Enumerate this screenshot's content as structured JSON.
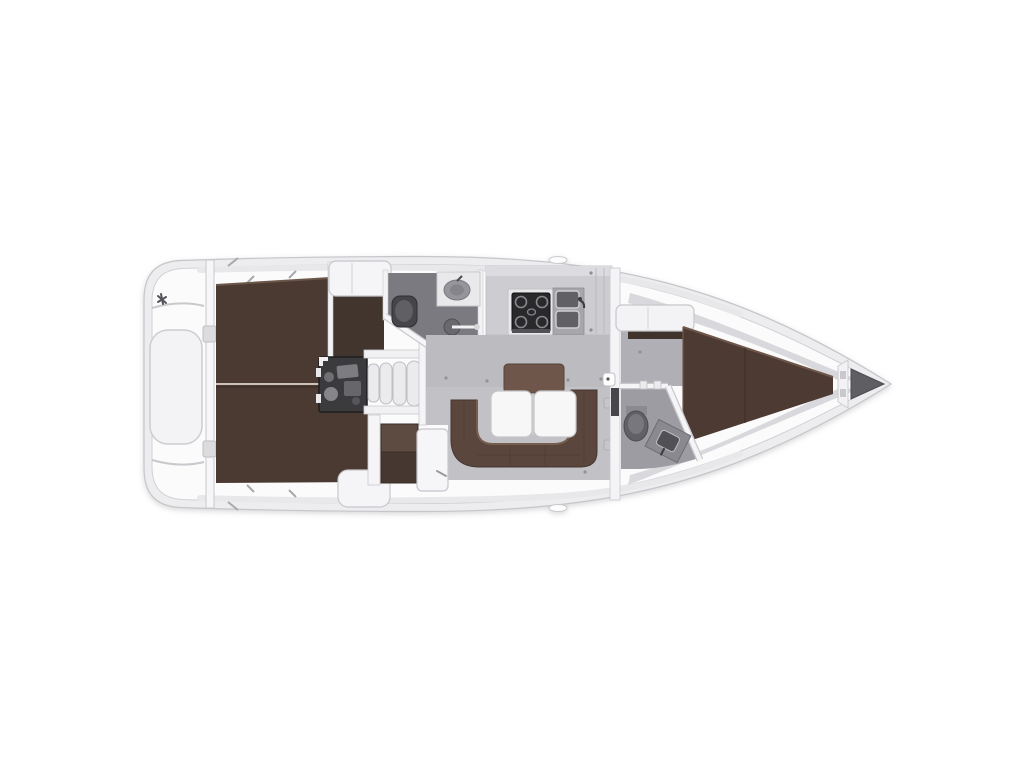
{
  "diagram": {
    "type": "yacht-interior-floor-plan",
    "orientation": "bow-right-stern-left",
    "rooms": [
      "transom-swim-platform",
      "aft-cabin-port-berth",
      "aft-cabin-starboard-berth",
      "engine-compartment",
      "companionway-steps",
      "aft-heads-bathroom",
      "wardrobe-locker",
      "galley",
      "salon-dinette",
      "nav-station",
      "forward-heads-bathroom",
      "forward-cabin-v-berth",
      "anchor-locker"
    ],
    "fixtures": [
      "double-berth",
      "double-berth",
      "v-berth",
      "u-shaped-sofa",
      "backrest-cushion",
      "folding-table",
      "chart-table",
      "nav-seat",
      "stove",
      "double-sink",
      "toilet",
      "washbasin",
      "shower-head",
      "toilet",
      "washbasin",
      "engine",
      "steps",
      "stern-hatch",
      "hinges",
      "door-latch",
      "anchor-well"
    ]
  },
  "palette": {
    "background": "#ffffff",
    "hull_rim": "#ededf0",
    "hull_inner": "#fbfbfc",
    "outline": "#c6c6ca",
    "deck_shade": "#d2d1d6",
    "rim_strip": "#e8e8eb",
    "berth_brown": "#4b3a32",
    "berth_entry_brown": "#42352d",
    "vberth_brown": "#4d3b33",
    "sofa_brown": "#5a463c",
    "backrest_brown": "#6e564b",
    "nav_seat_brown": "#5d4a40",
    "nav_seat_dark": "#463831",
    "salon_floor": "#c2c1c6",
    "salon_floor_shade": "#b7b6bc",
    "fwd_floor": "#b0afb5",
    "aft_heads_floor": "#7b7a80",
    "fwd_heads_floor": "#9d9ca2",
    "counter_gray": "#cdccd1",
    "counter_light": "#dcdbdf",
    "stove_black": "#29292c",
    "burner_gray": "#88888d",
    "sink_gray": "#a7a6ab",
    "basin_dark": "#606065",
    "engine_dark": "#3b3b3e",
    "machinery_gray": "#85858a",
    "fixture_white": "#f4f4f6",
    "step_white": "#ebebee",
    "table_white": "#f7f7f8",
    "toilet_dark": "#46464a",
    "toilet_gray": "#606066",
    "toilet_light": "#77777c",
    "basin_oval": "#96959b",
    "fwd_sink_panel": "#8a898f",
    "fwd_sink_inner": "#505055",
    "anchor_dark": "#5e5e63",
    "wall_white": "#f5f5f7",
    "hinge_gray": "#d4d4d8",
    "screw_gray": "#94939a"
  }
}
